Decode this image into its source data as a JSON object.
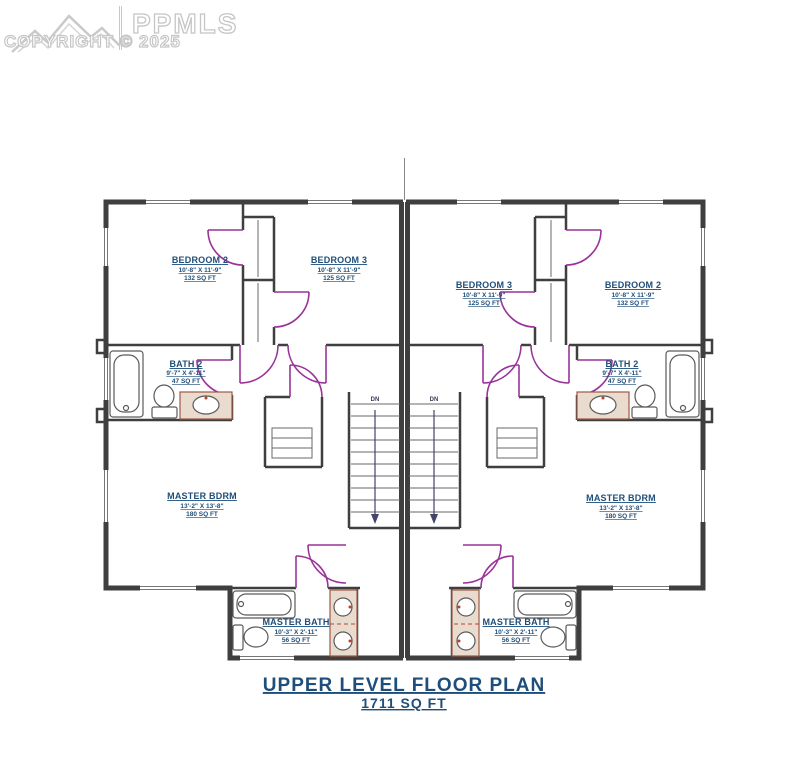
{
  "watermark": {
    "brand": "PPMLS",
    "copyright": "COPYRIGHT © 2025"
  },
  "plan": {
    "title": "UPPER LEVEL FLOOR PLAN",
    "total_area": "1711 SQ FT",
    "stair_label": "DN"
  },
  "colors": {
    "label_blue": "#1e4e79",
    "wall_gray": "#3f3f3f",
    "door_purple": "#993399",
    "vanity_tan": "#e9dbce",
    "watermark_gray": "#c6c6c6"
  },
  "rooms": {
    "left": {
      "bedroom2": {
        "name": "BEDROOM 2",
        "dims": "10'-8\" X 11'-9\"",
        "area": "132 SQ FT"
      },
      "bedroom3": {
        "name": "BEDROOM 3",
        "dims": "10'-8\" X 11'-9\"",
        "area": "125 SQ FT"
      },
      "bath2": {
        "name": "BATH 2",
        "dims": "9'-7\" X 4'-11\"",
        "area": "47 SQ FT"
      },
      "master_bdrm": {
        "name": "MASTER BDRM",
        "dims": "13'-2\" X 13'-8\"",
        "area": "180 SQ FT"
      },
      "master_bath": {
        "name": "MASTER BATH",
        "dims": "10'-3\" X 2'-11\"",
        "area": "56 SQ FT"
      }
    },
    "right": {
      "bedroom3": {
        "name": "BEDROOM 3",
        "dims": "10'-8\" X 11'-9\"",
        "area": "125 SQ FT"
      },
      "bedroom2": {
        "name": "BEDROOM 2",
        "dims": "10'-8\" X 11'-9\"",
        "area": "132 SQ FT"
      },
      "bath2": {
        "name": "BATH 2",
        "dims": "9'-7\" X 4'-11\"",
        "area": "47 SQ FT"
      },
      "master_bdrm": {
        "name": "MASTER BDRM",
        "dims": "13'-2\" X 13'-8\"",
        "area": "180 SQ FT"
      },
      "master_bath": {
        "name": "MASTER BATH",
        "dims": "10'-3\" X 2'-11\"",
        "area": "56 SQ FT"
      }
    }
  }
}
